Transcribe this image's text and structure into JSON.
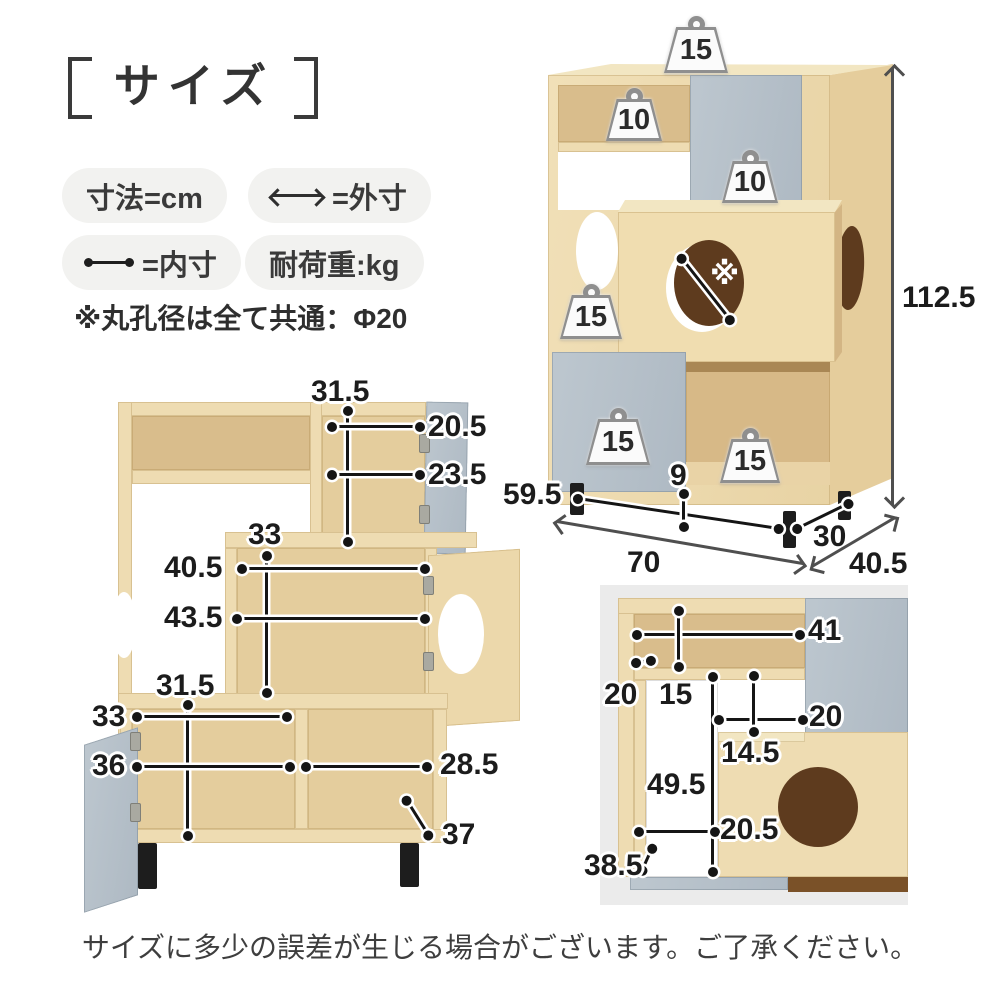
{
  "title": "サイズ",
  "legend": {
    "unit": "寸法=cm",
    "outer": "=外寸",
    "inner": "=内寸",
    "load": "耐荷重:kg",
    "hole_note": "※丸孔径は全て共通：Φ20"
  },
  "front_view": {
    "measures": {
      "upper_inner_height": "31.5",
      "upper_shelf_width": "20.5",
      "upper_inner_width": "23.5",
      "middle_inner_height": "33",
      "middle_shelf_width": "40.5",
      "middle_inner_width": "43.5",
      "lower_inner_height": "31.5",
      "lower_left_shelf_width": "33",
      "lower_left_inner_width": "36",
      "lower_right_inner_width": "28.5",
      "lower_inner_depth": "37"
    }
  },
  "iso_view": {
    "dims": {
      "height": "112.5",
      "inner_width": "59.5",
      "leg_height": "9",
      "outer_width": "70",
      "inner_depth": "30",
      "outer_depth": "40.5"
    },
    "weights": {
      "top": "15",
      "upper_shelf": "10",
      "upper_door": "10",
      "middle_left": "15",
      "lower_door": "15",
      "lower_cube": "15"
    },
    "hole_mark": "※"
  },
  "detail_view": {
    "measures": {
      "top_inner_width": "41",
      "side_panel": "20",
      "top_inner_height": "15",
      "upper_inner_width": "20",
      "step_height": "14.5",
      "lower_inner_height": "49.5",
      "lower_inner_width": "20.5",
      "base": "38.5"
    }
  },
  "footer": {
    "note": "サイズに多少の誤差が生じる場合がございます。ご了承ください。"
  },
  "colors": {
    "wood": "#eedcb2",
    "wood_interior": "#e4cd9d",
    "wood_deep": "#d9bd8c",
    "gray_panel": "#b7c1ca",
    "hole_dark": "#5e3b1e",
    "measure_line": "#151515",
    "outer_arrow": "#4f4f4f",
    "photo_bg": "#ebebeb"
  }
}
